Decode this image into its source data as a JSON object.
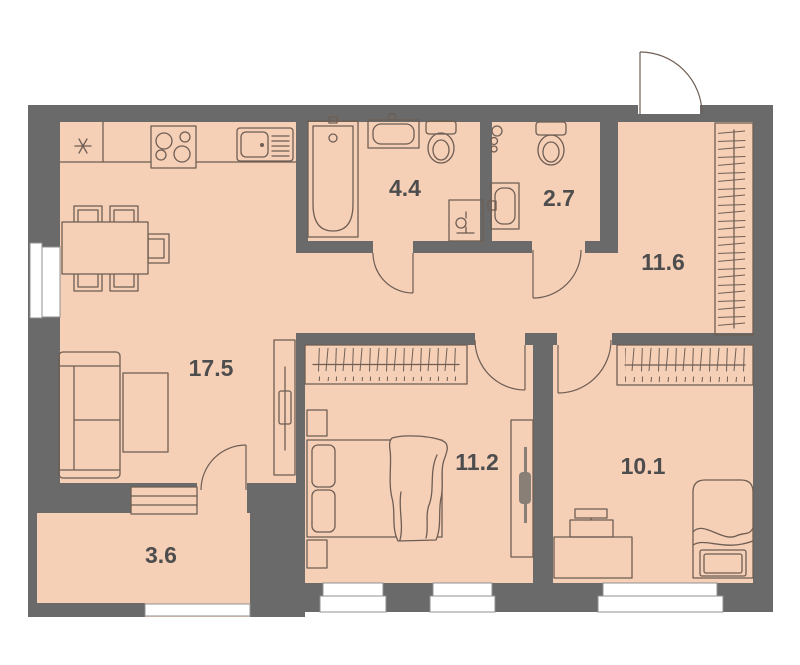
{
  "floor_plan": {
    "type": "apartment-floor-plan",
    "rooms": [
      {
        "name": "kitchen-living-room",
        "area_label": "17.5"
      },
      {
        "name": "bathroom",
        "area_label": "4.4"
      },
      {
        "name": "toilet",
        "area_label": "2.7"
      },
      {
        "name": "hallway",
        "area_label": "11.6"
      },
      {
        "name": "bedroom-1",
        "area_label": "11.2"
      },
      {
        "name": "bedroom-2",
        "area_label": "10.1"
      },
      {
        "name": "balcony",
        "area_label": "3.6"
      }
    ],
    "furniture_icons": [
      "fridge-icon",
      "stove-icon",
      "kitchen-sink-icon",
      "dining-table-icon",
      "chair-icon",
      "sofa-icon",
      "coffee-table-icon",
      "tv-stand-icon",
      "balcony-cabinet-icon",
      "bathtub-icon",
      "wall-sink-icon",
      "toilet-icon",
      "washing-machine-icon",
      "pipes-icon",
      "wardrobe-icon",
      "double-bed-icon",
      "nightstand-icon",
      "single-bed-icon",
      "desk-icon",
      "monitor-icon",
      "window-icon",
      "door-swing-icon",
      "entrance-door-icon"
    ],
    "colors": {
      "floor_fill": "#f6cfb7",
      "wall_fill": "#6a6a6a",
      "furniture_line": "#6e5e54",
      "label_text": "#4d4d4d",
      "window_fill": "#ffffff",
      "background": "#ffffff"
    }
  }
}
